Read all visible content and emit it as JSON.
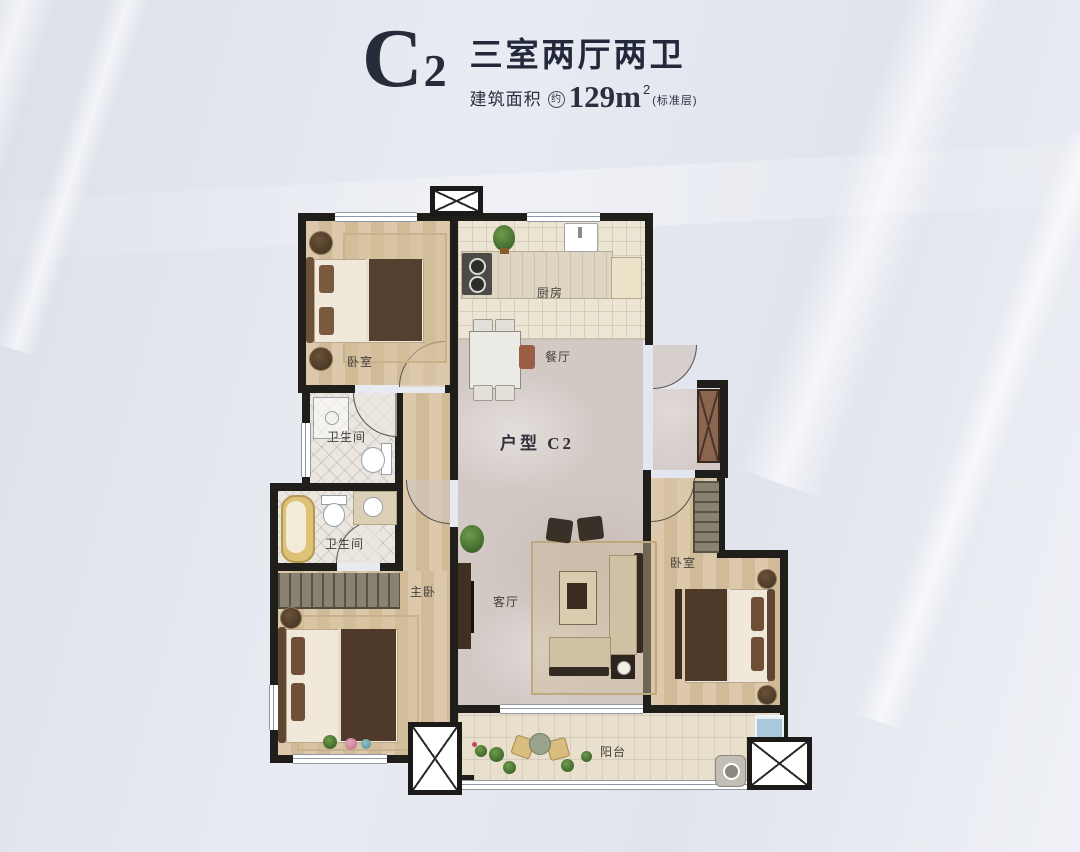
{
  "header": {
    "unit_code": "C2",
    "layout_title": "三室两厅两卫",
    "area_label": "建筑面积",
    "area_approx": "约",
    "area_value": "129m",
    "area_sup": "2",
    "floor_note": "(标准层)"
  },
  "labels": {
    "bedroom_north": "卧室",
    "kitchen": "厨房",
    "dining": "餐厅",
    "bath_upper": "卫生间",
    "bath_lower": "卫生间",
    "master": "主卧",
    "living": "客厅",
    "bedroom_east": "卧室",
    "balcony": "阳台",
    "unit": "户型 C2"
  },
  "colors": {
    "wall": "#201e1b",
    "wood_floor": "#d6c0a1",
    "marble_floor": "#d2c9c5",
    "bath_tile": "#ebe7e0",
    "balcony_tile": "#e8e0cd",
    "title_text": "#272c3a",
    "bathtub_gold": "#dcc177",
    "balcony_window_blue": "#a9c9db",
    "entry_door_brown": "#8a6650"
  }
}
